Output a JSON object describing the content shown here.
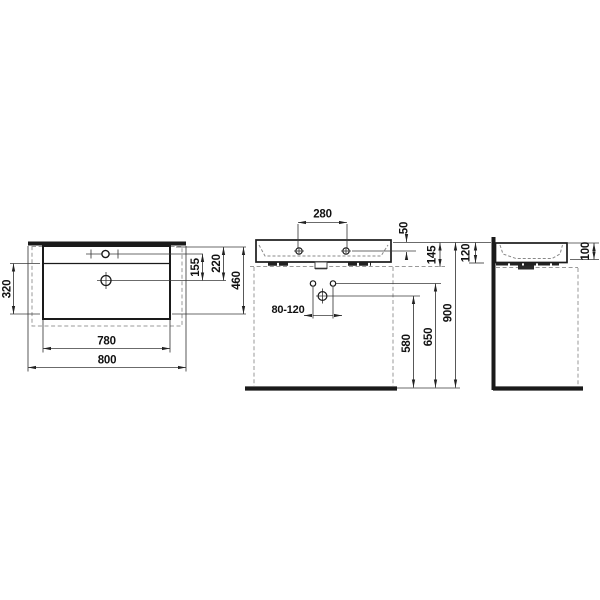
{
  "dims": {
    "plan": {
      "bowl_depth": "320",
      "width_inner": "780",
      "width_total": "800",
      "tap_to_drain": "155",
      "back_to_drain": "220",
      "depth_total": "460"
    },
    "front": {
      "tap_spacing": "280",
      "rim_to_tap": "50",
      "rim_to_underside": "145",
      "waste_offset_range": "80-120",
      "waste_height": "580",
      "supply_height": "650",
      "rim_height": "900"
    },
    "side": {
      "basin_height": "120",
      "bowl_inner_depth": "100"
    }
  },
  "colors": {
    "object_line": "#1a1a1a",
    "dimension_line": "#3a3a3a",
    "hidden_line": "#999999",
    "background": "#ffffff"
  }
}
